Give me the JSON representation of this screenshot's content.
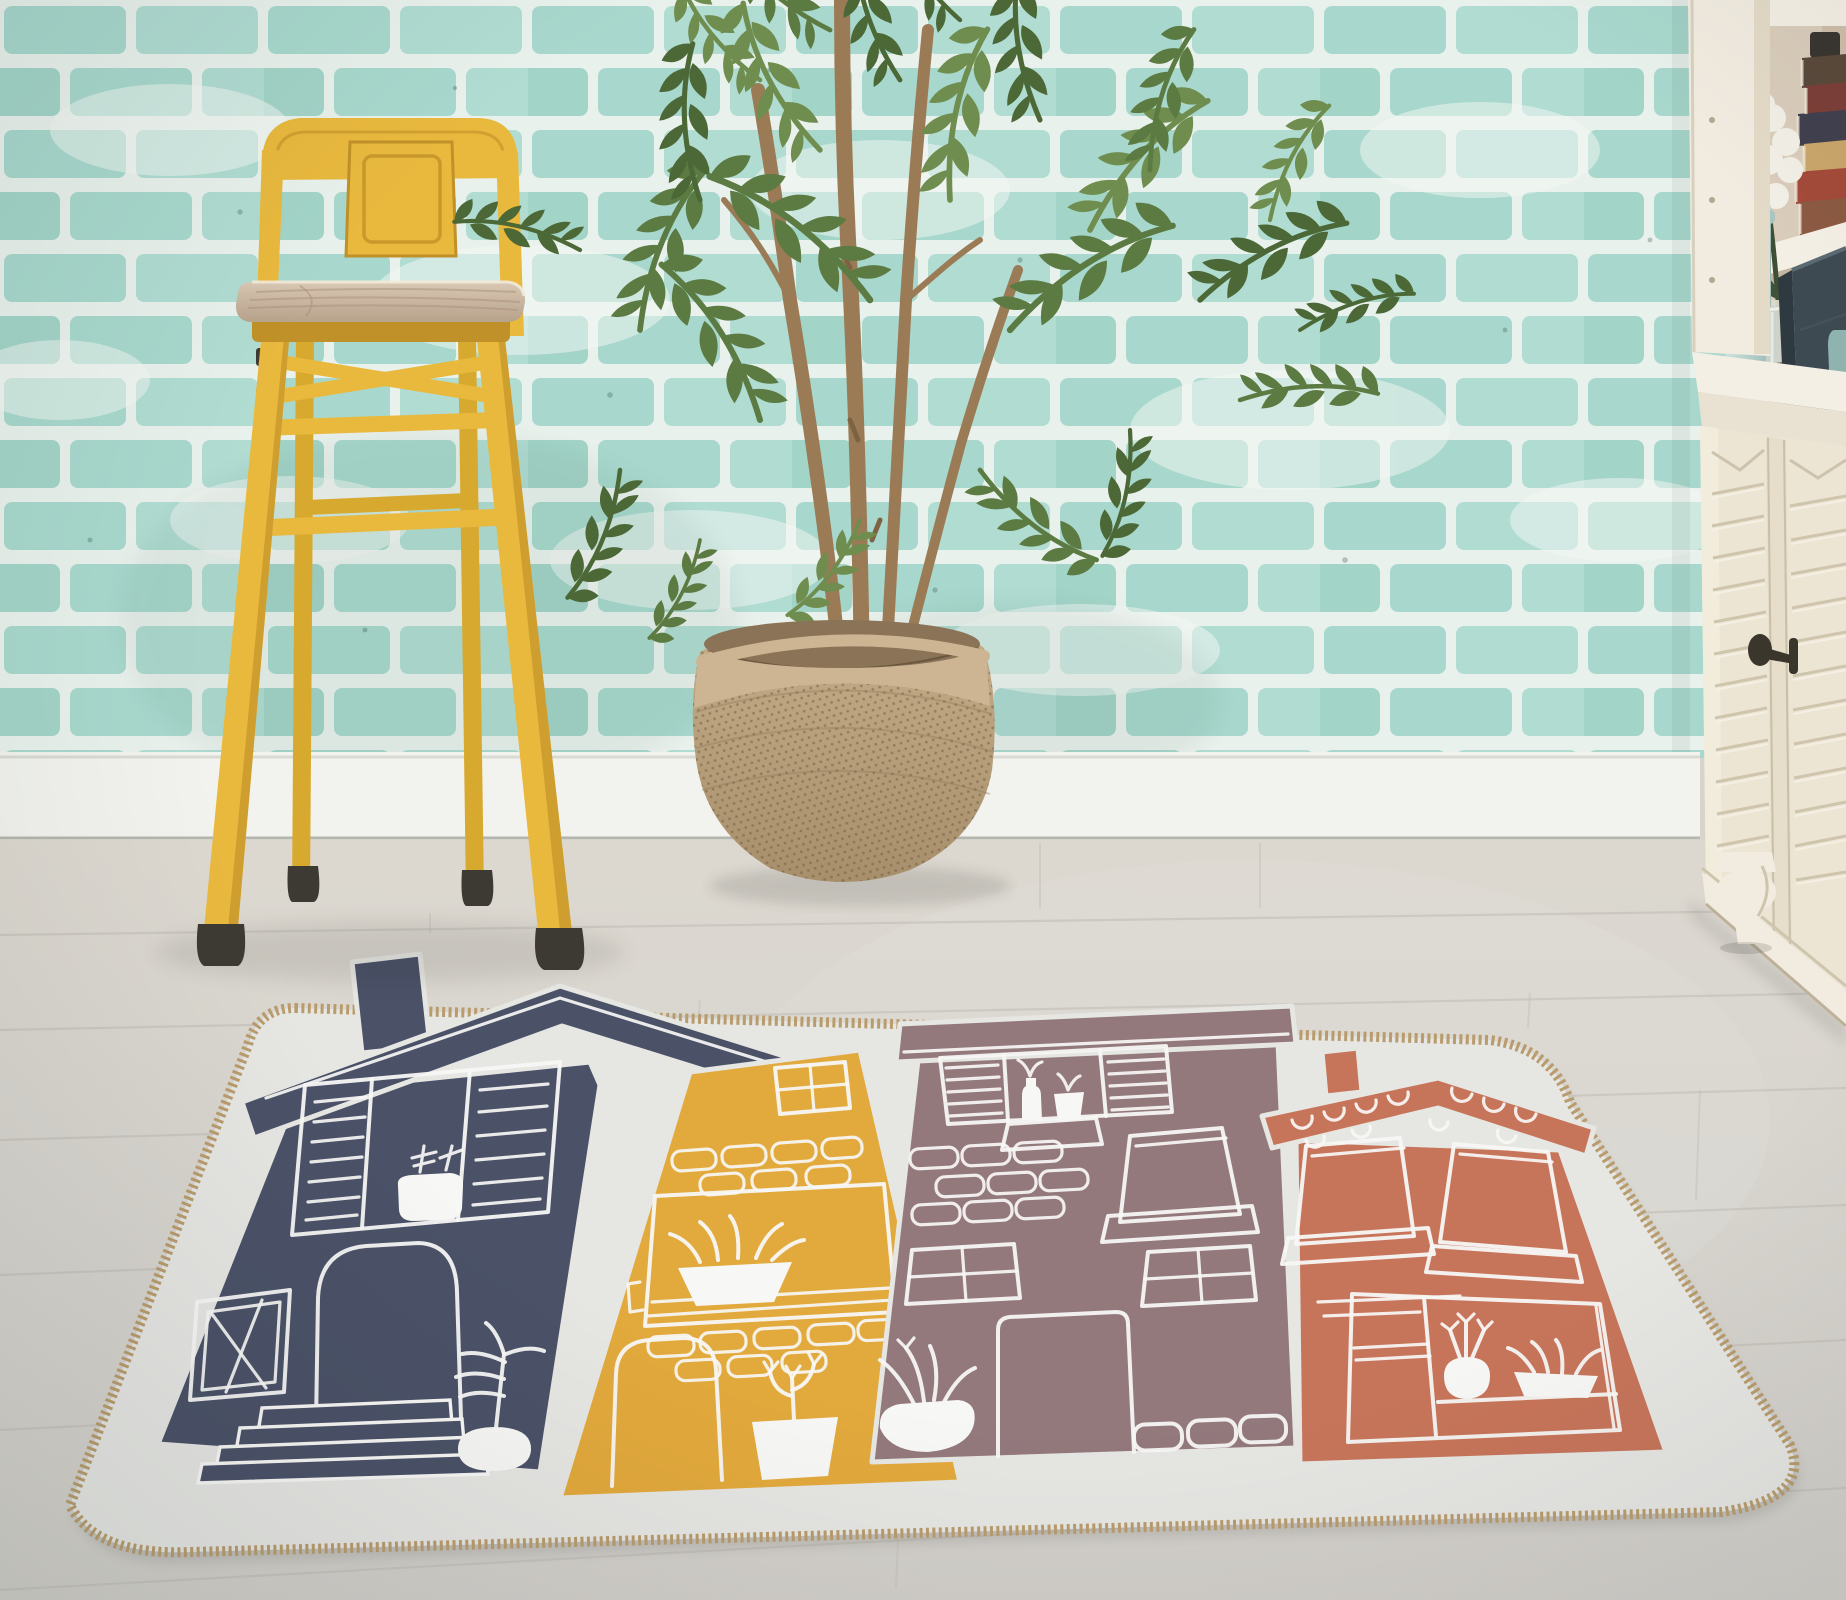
{
  "meta": {
    "kind": "product-photograph",
    "subject": "Rectangular kids rug with hand-drawn house print, styled in a room with mint brick wall"
  },
  "scene": {
    "wall": {
      "label": "mint painted brick wall"
    },
    "baseboard": {
      "label": "white baseboard"
    },
    "floor": {
      "label": "light wood plank floor"
    },
    "stool": {
      "label": "yellow tolix-style bar stool with wooden seat"
    },
    "tree": {
      "label": "artificial leafy tree"
    },
    "basket": {
      "label": "woven rope basket planter"
    },
    "shelf_items": [
      "stacked books",
      "white flower in pale vase",
      "light-teal tin canister",
      "glass jar",
      "dark storage box",
      "teal cup"
    ],
    "sideboard": {
      "label": "cream sideboard with louvered doors, iron key handle and turned foot"
    },
    "rug": {
      "label": "light-grey rug with braided tan edge and four hand-drawn houses",
      "houses": [
        {
          "name": "navy house",
          "features": [
            "chimney",
            "wide gable roof",
            "shuttered window with white potted plant",
            "arched door",
            "front steps",
            "small casement window",
            "white palm plant"
          ]
        },
        {
          "name": "yellow house",
          "features": [
            "four-pane attic window",
            "brick rows",
            "large window with white plant bowl",
            "arched door",
            "white potted cactus"
          ]
        },
        {
          "name": "mauve house",
          "features": [
            "parapet cap roof",
            "shuttered window with two white vases",
            "scattered bricks",
            "awning window with sill",
            "two four-pane windows",
            "door",
            "white plant bowl",
            "three bricks"
          ]
        },
        {
          "name": "orange house",
          "features": [
            "chimney",
            "shingled gable roof",
            "two awning windows with sills",
            "large lower window with white radish plant and leaf bowl"
          ]
        }
      ]
    }
  },
  "palette": {
    "navy": "#4b5268",
    "yellow": "#e2a93c",
    "mauve": "#93797c",
    "orange": "#c7755a",
    "line": "#f7f7f5",
    "field": "#e6e6e3",
    "braid": "#b99c6e",
    "brick1": "#a8d8cd",
    "brick2": "#b0dcd2",
    "brick3": "#a3d4c8",
    "mortar": "#e9f1ec",
    "baseboard": "#f2f3ee",
    "floor": "#d8d4cc",
    "floorline": "#c0bcb4",
    "stool": "#e9b93e",
    "stooldark": "#d8a92f",
    "stoolshade": "#c09128",
    "feet": "#3d3a33",
    "wood": "#cdbaa5",
    "woodgrain": "#a98f77",
    "trunk": "#9a7b55",
    "leaf1": "#5c7b43",
    "leaf2": "#4b6836",
    "leaf3": "#6f8d4e",
    "basket": "#b9a07c",
    "basketband": "#cdb593",
    "basketdark": "#6c5a41",
    "cream": "#f1ebe0",
    "cream2": "#ece5d4",
    "creamline": "#cabfa6",
    "nook": "#d9ccbb",
    "shelfwhite": "#f4efe4",
    "handle": "#3a362c",
    "box": "#3e4a52",
    "boxside": "#2f3940",
    "tin": "#bcd3d1",
    "glass": "#ccd2c9",
    "teal": "#8fb3ae",
    "flowergreen": "#3f4f35",
    "books": [
      "#8c5a43",
      "#a44b3b",
      "#c9a66b",
      "#41404f",
      "#7c3f38",
      "#5a4a3c"
    ]
  }
}
